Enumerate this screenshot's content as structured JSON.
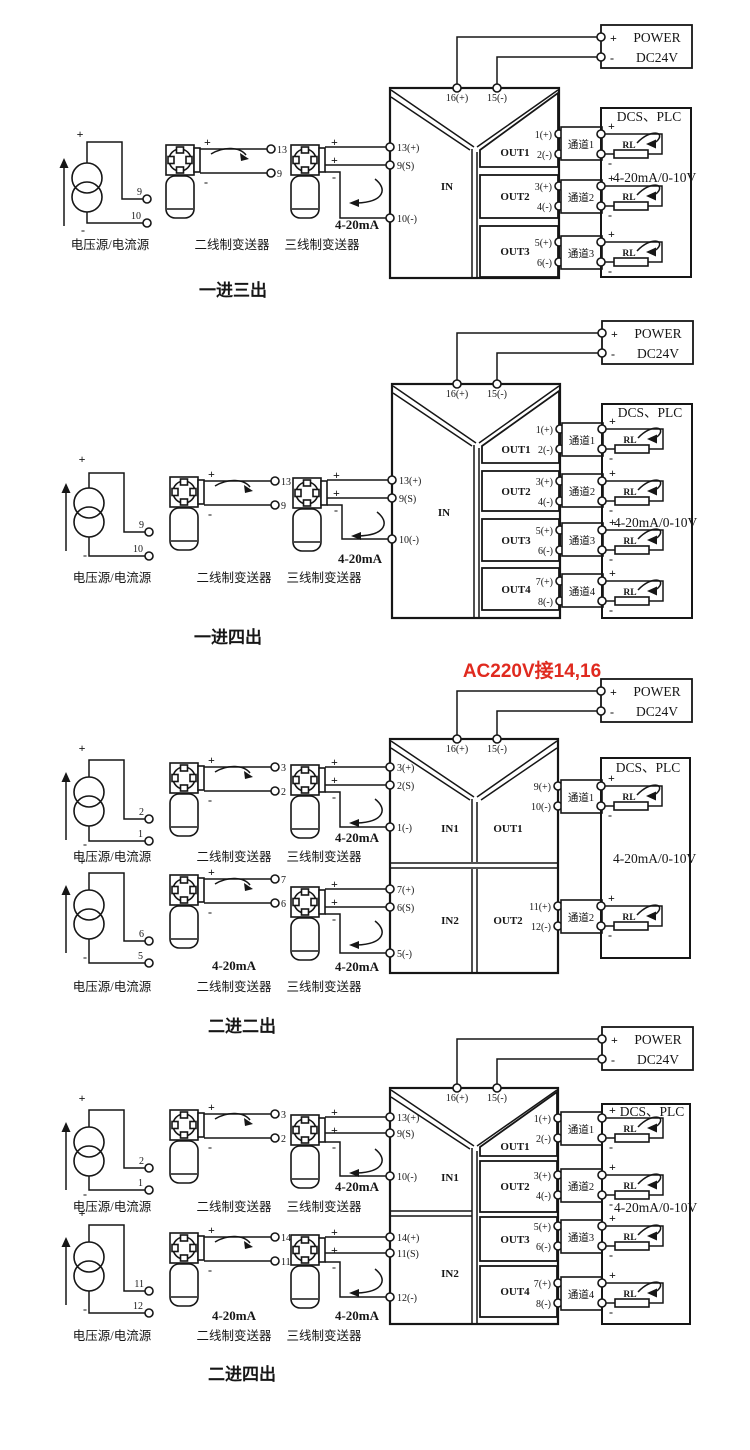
{
  "colors": {
    "ink": "#161616",
    "red": "#e02a1f",
    "background": "#ffffff"
  },
  "shared": {
    "plus": "+",
    "minus": "-",
    "power_title": "POWER",
    "power_voltage": "DC24V",
    "dcs_title": "DCS、PLC",
    "rl": "RL",
    "io_range": "4-20mA/0-10V",
    "loop_current": "4-20mA",
    "source_label": "电压源/电流源",
    "t2_label": "二线制变送器",
    "t3_label": "三线制变送器",
    "top_terms": [
      "16(+)",
      "15(-)"
    ]
  },
  "red_note": "AC220V接14,16",
  "diagrams": [
    {
      "title": "一进三出",
      "in_label": "IN",
      "in_terms": [
        "13(+)",
        "9(S)",
        "10(-)"
      ],
      "out_labels": [
        "OUT1",
        "OUT2",
        "OUT3"
      ],
      "out_terms": [
        "1(+)",
        "2(-)",
        "3(+)",
        "4(-)",
        "5(+)",
        "6(-)"
      ],
      "channels": [
        "通道1",
        "通道2",
        "通道3"
      ],
      "source_terms": [
        "9",
        "10"
      ],
      "t2_terms": [
        "13",
        "9"
      ]
    },
    {
      "title": "一进四出",
      "in_label": "IN",
      "in_terms": [
        "13(+)",
        "9(S)",
        "10(-)"
      ],
      "out_labels": [
        "OUT1",
        "OUT2",
        "OUT3",
        "OUT4"
      ],
      "out_terms": [
        "1(+)",
        "2(-)",
        "3(+)",
        "4(-)",
        "5(+)",
        "6(-)",
        "7(+)",
        "8(-)"
      ],
      "channels": [
        "通道1",
        "通道2",
        "通道3",
        "通道4"
      ],
      "source_terms": [
        "9",
        "10"
      ],
      "t2_terms": [
        "13",
        "9"
      ]
    },
    {
      "title": "二进二出",
      "in_labels": [
        "IN1",
        "IN2"
      ],
      "in_terms_1": [
        "3(+)",
        "2(S)",
        "1(-)"
      ],
      "in_terms_2": [
        "7(+)",
        "6(S)",
        "5(-)"
      ],
      "out_labels": [
        "OUT1",
        "OUT2"
      ],
      "out_terms": [
        "9(+)",
        "10(-)",
        "11(+)",
        "12(-)"
      ],
      "channels": [
        "通道1",
        "通道2"
      ],
      "source_terms_1": [
        "2",
        "1"
      ],
      "t2_terms_1": [
        "3",
        "2"
      ],
      "source_terms_2": [
        "6",
        "5"
      ],
      "t2_terms_2": [
        "7",
        "6"
      ]
    },
    {
      "title": "二进四出",
      "in_labels": [
        "IN1",
        "IN2"
      ],
      "in_terms_1": [
        "13(+)",
        "9(S)",
        "10(-)"
      ],
      "in_terms_2": [
        "14(+)",
        "11(S)",
        "12(-)"
      ],
      "out_labels": [
        "OUT1",
        "OUT2",
        "OUT3",
        "OUT4"
      ],
      "out_terms": [
        "1(+)",
        "2(-)",
        "3(+)",
        "4(-)",
        "5(+)",
        "6(-)",
        "7(+)",
        "8(-)"
      ],
      "channels": [
        "通道1",
        "通道2",
        "通道3",
        "通道4"
      ],
      "source_terms_1": [
        "2",
        "1"
      ],
      "t2_terms_1": [
        "3",
        "2"
      ],
      "source_terms_2": [
        "11",
        "12"
      ],
      "t2_terms_2": [
        "14",
        "11"
      ]
    }
  ]
}
